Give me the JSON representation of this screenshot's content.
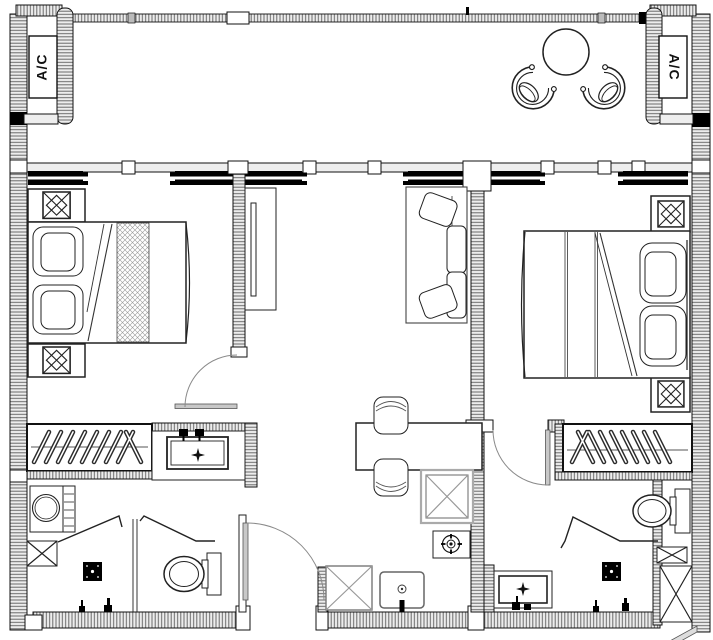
{
  "title": "Two-bedroom apartment floor plan",
  "labels": {
    "ac_left": "A/C",
    "ac_right": "A/C"
  },
  "colors": {
    "line": "#1a1a1a",
    "wall_fill": "#ededed",
    "wall_hatch": "#666666",
    "window_bar": "#000000",
    "door_leaf": "#c8c8c8",
    "background": "#ffffff"
  },
  "rooms": [
    "balcony",
    "bedroom-left",
    "living-dining",
    "bedroom-right",
    "kitchen",
    "dressing-left",
    "bathroom-left",
    "dressing-right",
    "bathroom-right"
  ],
  "symbols": [
    "ac-unit",
    "round-table",
    "tub-chair",
    "double-bed",
    "pillow",
    "nightstand",
    "wardrobe-hangers",
    "tv-console",
    "sofa",
    "dining-table",
    "dining-chair",
    "refrigerator-box",
    "stove-burner",
    "kitchen-sink",
    "washing-machine",
    "toilet",
    "vanity-basin",
    "shower-screen",
    "floor-drain",
    "door-swing",
    "window-pair",
    "duct-shaft"
  ]
}
